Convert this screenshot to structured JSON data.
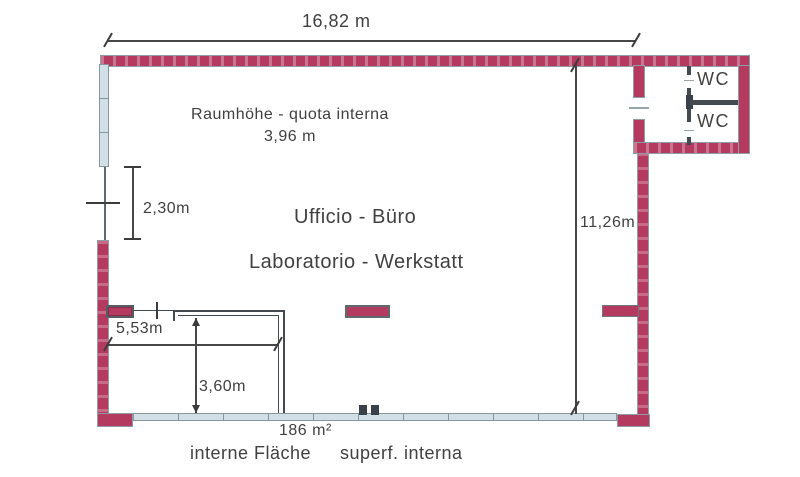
{
  "plan": {
    "dimensions": {
      "total_width": "16,82 m",
      "interior_height_label": "Raumhöhe - quota interna",
      "interior_height_value": "3,96 m",
      "door_height": "2,30m",
      "room_depth": "11,26m",
      "inner_width": "5,53m",
      "inner_depth": "3,60m"
    },
    "rooms": {
      "office": "Ufficio - Büro",
      "workshop": "Laboratorio - Werkstatt",
      "wc_top": "WC",
      "wc_bottom": "WC"
    },
    "area": {
      "value": "186 m²",
      "label_german": "interne Fläche",
      "label_italian": "superf. interna"
    },
    "colors": {
      "wall": "#b43a5f",
      "window": "#d2e0e5",
      "line": "#474747"
    }
  }
}
